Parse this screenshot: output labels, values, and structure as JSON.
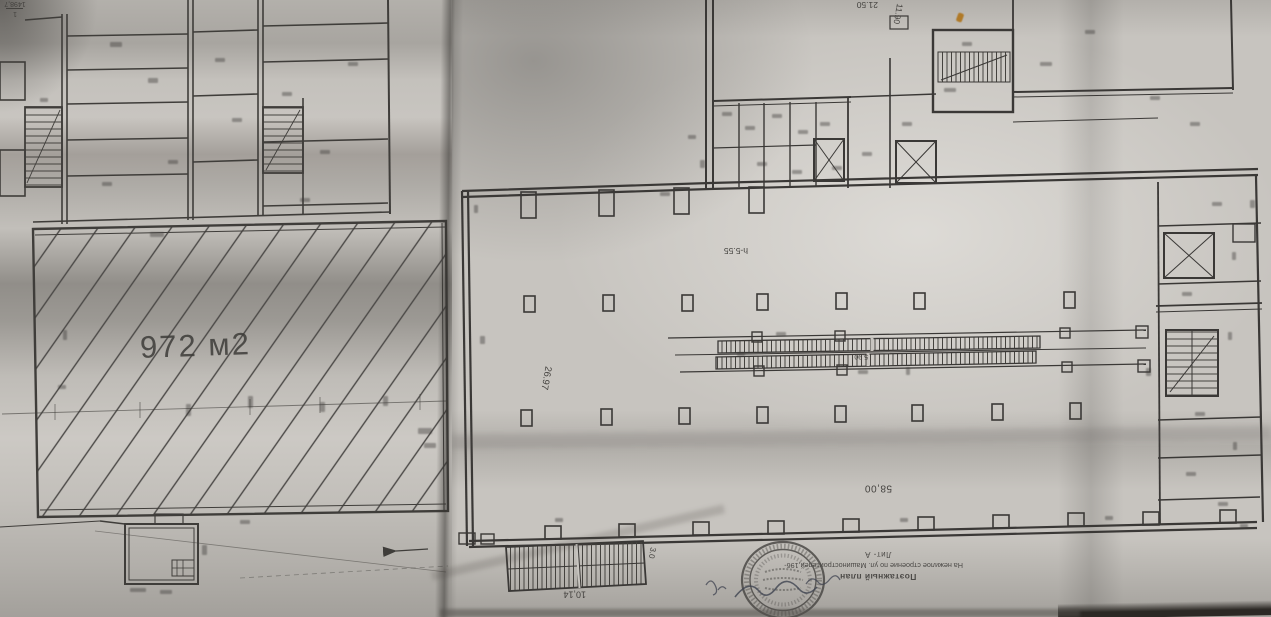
{
  "left_sheet": {
    "area_label": "972 м2"
  },
  "right_sheet": {
    "hall": {
      "height_label": "h-5.55",
      "length_label": "58,00",
      "width_label": "26.97",
      "room_number": "1",
      "room_area": "1498,7"
    },
    "dims": {
      "top": "21.50",
      "top_right": "11.90",
      "escalator": "5.90",
      "ramp_length": "10,14",
      "ramp_width": "3.0"
    },
    "title_block": {
      "line1": "Поэтажный план",
      "line2": "На нежилое строение по ул. Машиностроителей,196-",
      "line3": "Лит- А"
    }
  },
  "colors": {
    "ink": "#3a3836",
    "paper_left": "#c6c3be",
    "paper_right": "#c7c4bf",
    "accent_speck": "#b07a28"
  }
}
